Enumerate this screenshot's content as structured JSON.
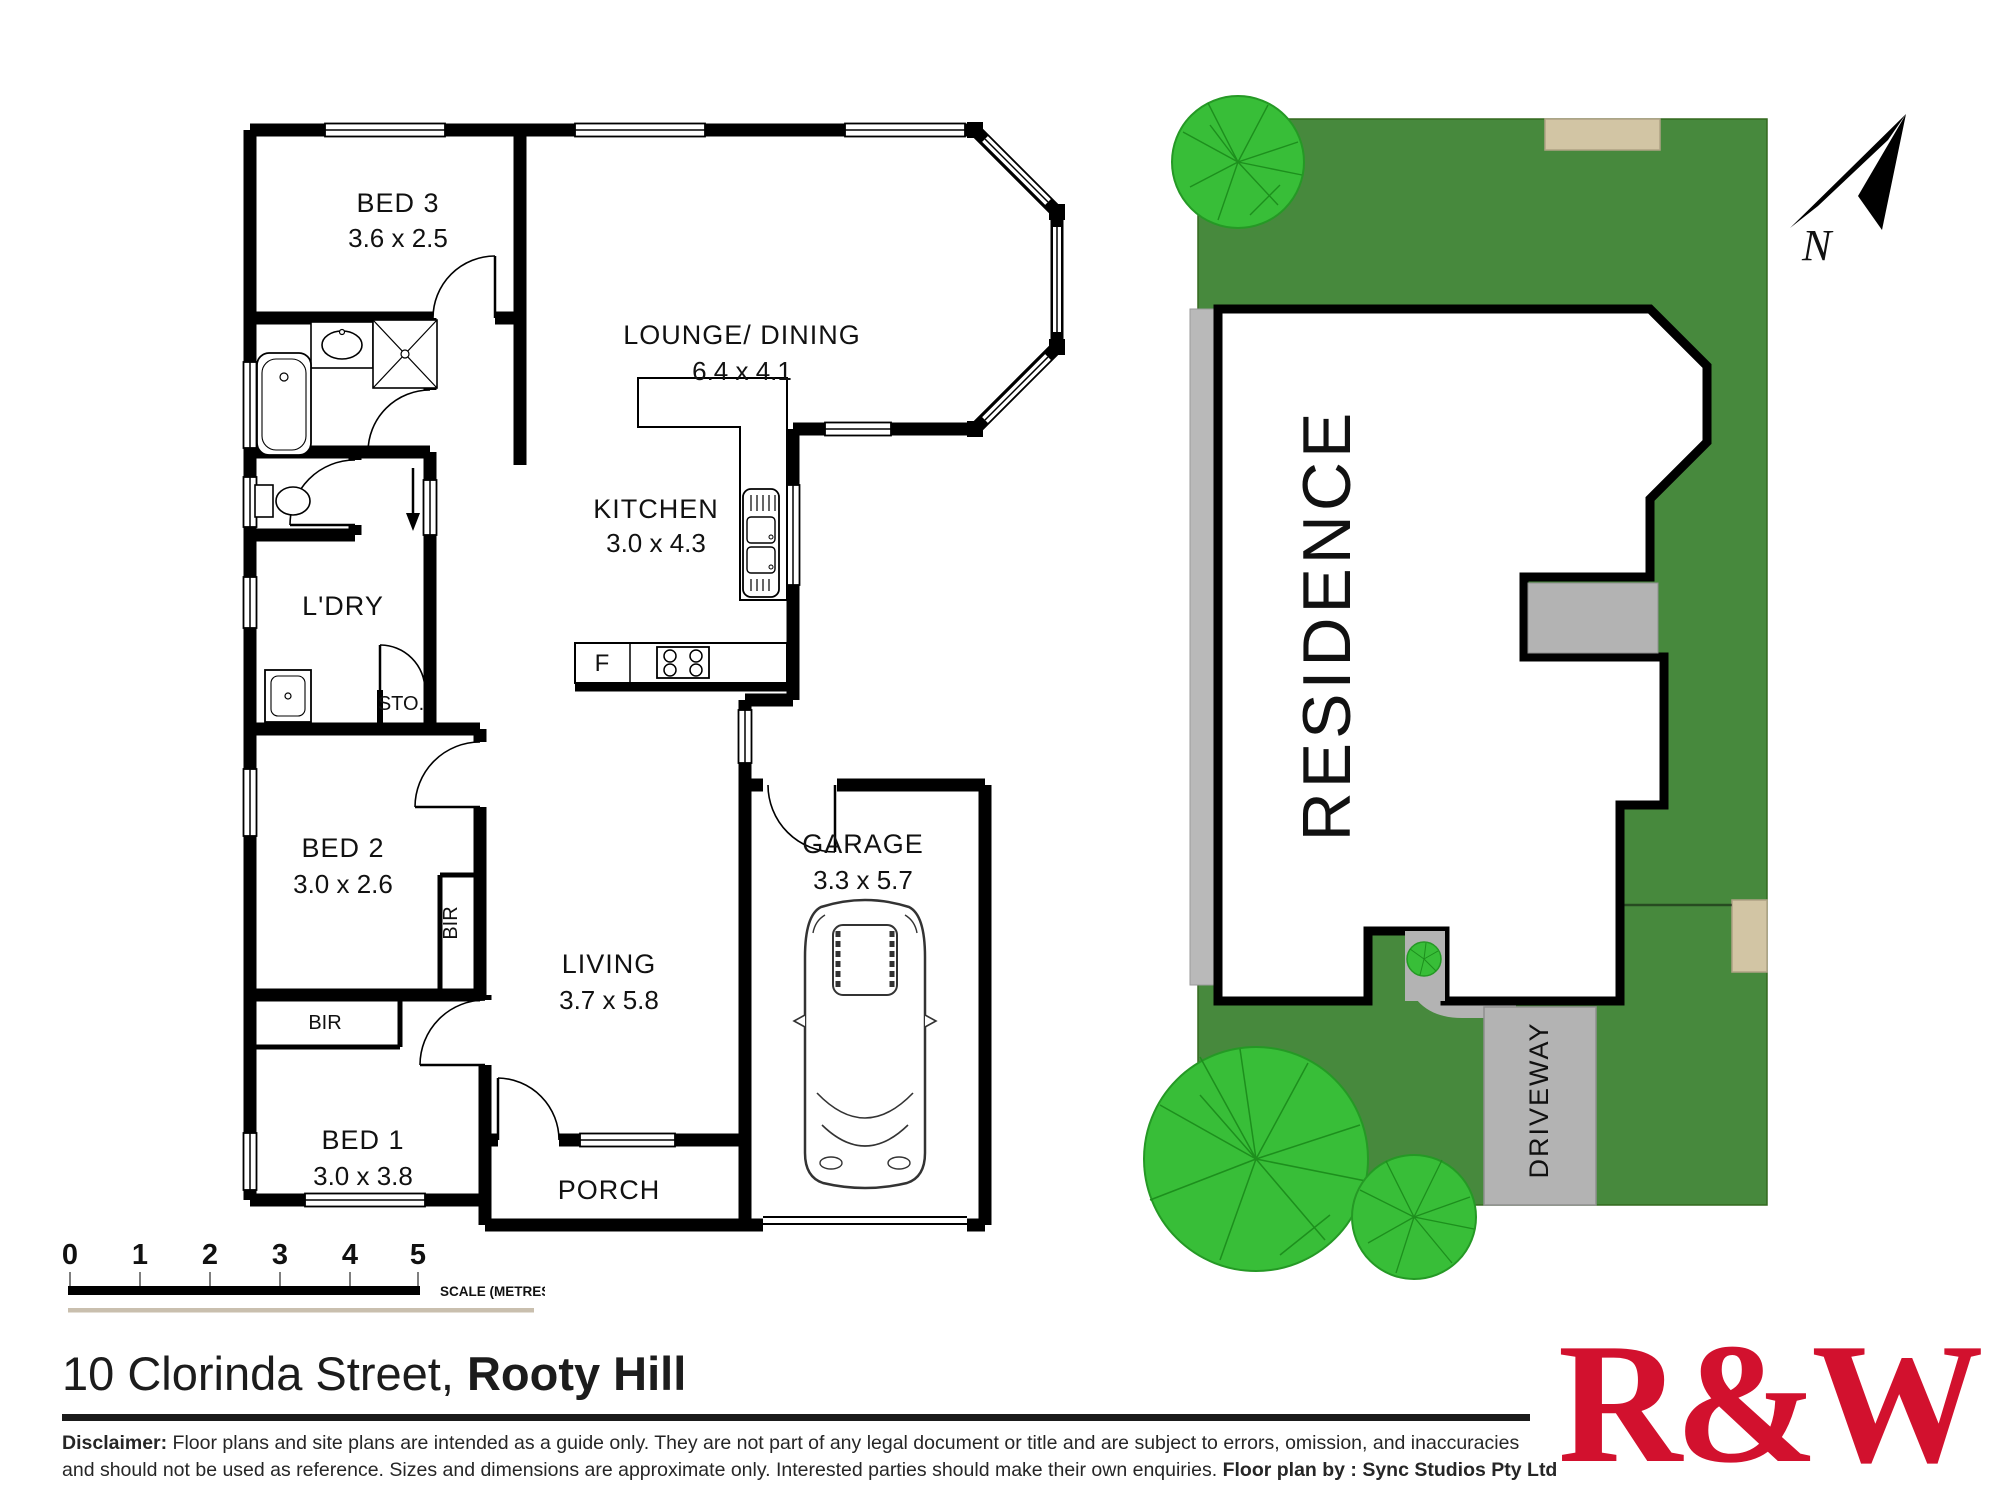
{
  "floor_plan": {
    "rooms": {
      "bed3": {
        "name": "BED 3",
        "dims": "3.6 x 2.5"
      },
      "lounge": {
        "name": "LOUNGE/ DINING",
        "dims": "6.4 x 4.1"
      },
      "kitchen": {
        "name": "KITCHEN",
        "dims": "3.0 x 4.3"
      },
      "laundry": {
        "name": "L'DRY"
      },
      "storage": {
        "name": "STO."
      },
      "bed2": {
        "name": "BED 2",
        "dims": "3.0 x 2.6"
      },
      "living": {
        "name": "LIVING",
        "dims": "3.7 x 5.8"
      },
      "bed1": {
        "name": "BED 1",
        "dims": "3.0 x 3.8"
      },
      "garage": {
        "name": "GARAGE",
        "dims": "3.3 x 5.7"
      },
      "porch": {
        "name": "PORCH"
      }
    },
    "fixtures": {
      "fridge": "F",
      "bir": "BIR"
    }
  },
  "site_plan": {
    "residence_label": "RESIDENCE",
    "driveway_label": "DRIVEWAY"
  },
  "compass": {
    "north_label": "N"
  },
  "scale_bar": {
    "ticks": [
      "0",
      "1",
      "2",
      "3",
      "4",
      "5"
    ],
    "label": "SCALE (METRES)"
  },
  "footer": {
    "address_street": "10 Clorinda Street, ",
    "address_suburb": "Rooty Hill",
    "disclaimer_bold": "Disclaimer:",
    "disclaimer_line1": " Floor plans and site plans are intended as a guide only. They are not part of any legal document or title and are subject to errors, omission, and inaccuracies",
    "disclaimer_line2": "and should not be used as reference. Sizes and dimensions are approximate only. Interested parties should make their own enquiries. ",
    "credit_bold": "Floor plan by : Sync Studios Pty Ltd"
  },
  "brand": {
    "logo_text": "R&W"
  },
  "colors": {
    "lawn": "#47893D",
    "tree": "#38BE38",
    "paving": "#B3B3B3",
    "sand": "#D2C5A4",
    "brand_red": "#D2112E",
    "wall": "#000000"
  }
}
